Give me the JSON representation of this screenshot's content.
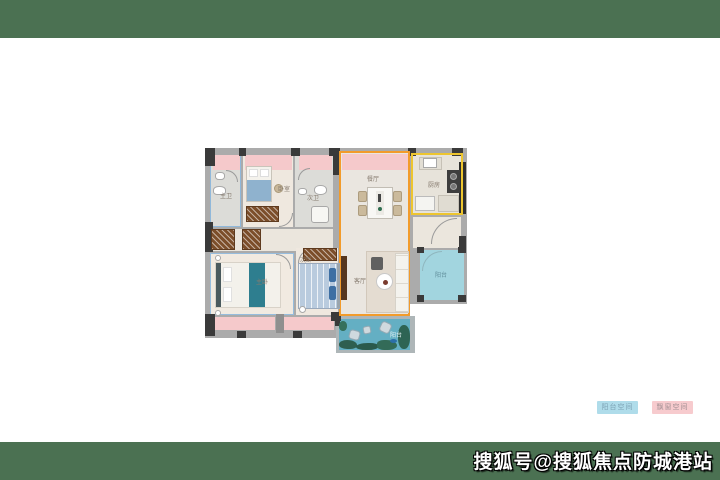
{
  "watermark": {
    "text": "搜狐号@搜狐焦点防城港站"
  },
  "legend": {
    "items": [
      {
        "label": "阳台空间",
        "bg": "#AFDCEA",
        "color": "#7EA3B5"
      },
      {
        "label": "飘窗空间",
        "bg": "#F7CBCE",
        "color": "#A29094"
      }
    ]
  },
  "floorplan": {
    "labels": {
      "master_bath": "主卫",
      "bedroom": "卧室",
      "second_bath": "次卫",
      "master_bedroom": "主卧",
      "second_bedroom": "次卧",
      "dining": "餐厅",
      "kitchen": "厨房",
      "living": "客厅",
      "balcony_right": "阳台",
      "balcony_bottom": "阳台"
    },
    "zone_colors": {
      "balcony_fill": "#A2D5DF",
      "bay_window_fill": "#F5C9CB",
      "living_outline": "#F29B2B",
      "kitchen_outline": "#EDC52F",
      "band_green": "#4B7152"
    }
  }
}
